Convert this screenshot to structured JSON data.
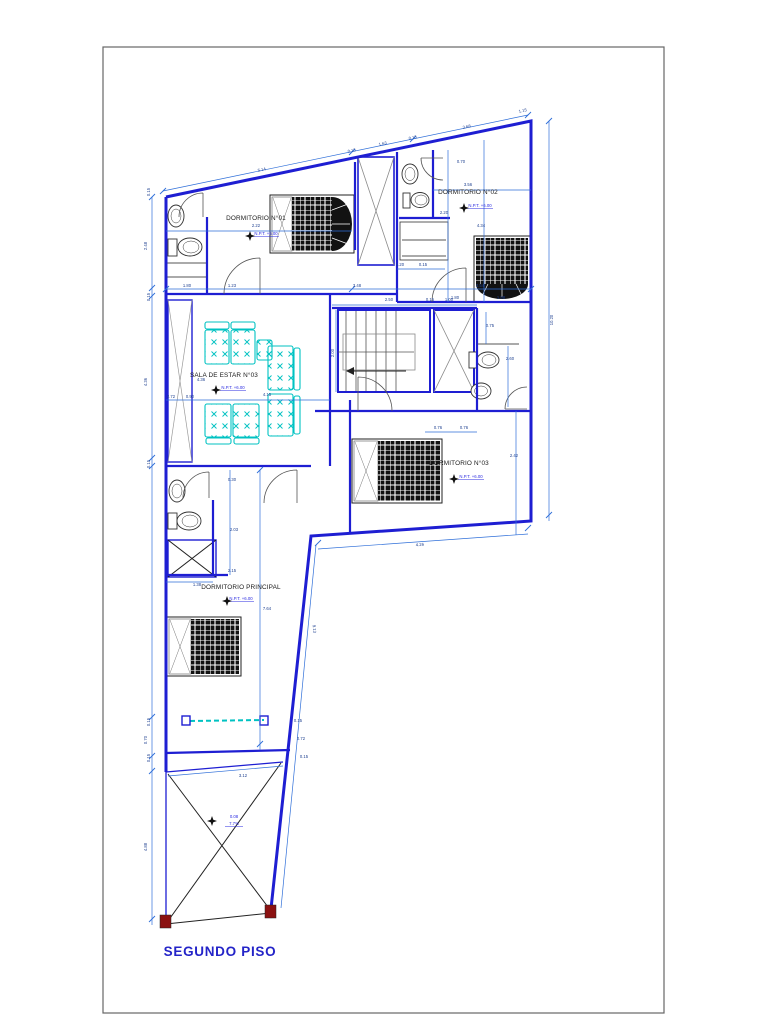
{
  "title": {
    "text": "SEGUNDO PISO"
  },
  "rooms": [
    {
      "label": "DORMITORIO N°01",
      "level": "N.P.T. +6.00",
      "lx": 256,
      "ly": 220,
      "vx": 266,
      "vy": 235,
      "sx": 250,
      "sy": 236
    },
    {
      "label": "DORMITORIO N°02",
      "level": "N.P.T. +6.00",
      "lx": 468,
      "ly": 194,
      "vx": 480,
      "vy": 207,
      "sx": 464,
      "sy": 208
    },
    {
      "label": "SALA DE ESTAR N°03",
      "level": "N.P.T. +6.00",
      "lx": 224,
      "ly": 377,
      "vx": 233,
      "vy": 389,
      "sx": 216,
      "sy": 390
    },
    {
      "label": "DORMITORIO N°03",
      "level": "N.P.T. +6.00",
      "lx": 459,
      "ly": 465,
      "vx": 471,
      "vy": 478,
      "sx": 454,
      "sy": 479
    },
    {
      "label": "DORMITORIO PRINCIPAL",
      "level": "N.P.T. +6.00",
      "lx": 241,
      "ly": 589,
      "vx": 241,
      "vy": 600,
      "sx": 227,
      "sy": 601
    }
  ],
  "patio_note": {
    "line1": "0.08",
    "line2": "7.7%",
    "x": 234,
    "y1": 818,
    "y2": 825,
    "sx": 212,
    "sy": 821
  },
  "dimensions": [
    {
      "t": "5.14",
      "x": 262,
      "y": 171,
      "r": -12
    },
    {
      "t": "0.15",
      "x": 352,
      "y": 152,
      "r": -12
    },
    {
      "t": "1.63",
      "x": 383,
      "y": 145,
      "r": -12
    },
    {
      "t": "0.15",
      "x": 413,
      "y": 139,
      "r": -12
    },
    {
      "t": "3.68",
      "x": 467,
      "y": 128,
      "r": -12
    },
    {
      "t": "1.15",
      "x": 523,
      "y": 112,
      "r": -12
    },
    {
      "t": "0.15",
      "x": 150,
      "y": 192,
      "r": -90
    },
    {
      "t": "2.48",
      "x": 147,
      "y": 246,
      "r": -90
    },
    {
      "t": "0.15",
      "x": 150,
      "y": 297,
      "r": -90
    },
    {
      "t": "4.36",
      "x": 147,
      "y": 382,
      "r": -90
    },
    {
      "t": "0.15",
      "x": 150,
      "y": 464,
      "r": -90
    },
    {
      "t": "0.15",
      "x": 150,
      "y": 722,
      "r": -90
    },
    {
      "t": "0.70",
      "x": 147,
      "y": 740,
      "r": -90
    },
    {
      "t": "0.15",
      "x": 150,
      "y": 758,
      "r": -90
    },
    {
      "t": "4.88",
      "x": 147,
      "y": 847,
      "r": -90
    },
    {
      "t": "10.20",
      "x": 553,
      "y": 320,
      "r": -90
    },
    {
      "t": "2.22",
      "x": 256,
      "y": 227
    },
    {
      "t": "1.80",
      "x": 187,
      "y": 287
    },
    {
      "t": "1.23",
      "x": 232,
      "y": 287
    },
    {
      "t": "3.48",
      "x": 357,
      "y": 287
    },
    {
      "t": "3.54",
      "x": 480,
      "y": 287
    },
    {
      "t": "1.20",
      "x": 400,
      "y": 266
    },
    {
      "t": "0.15",
      "x": 423,
      "y": 266
    },
    {
      "t": "2.50",
      "x": 389,
      "y": 301
    },
    {
      "t": "0.15",
      "x": 430,
      "y": 301
    },
    {
      "t": "1.00",
      "x": 449,
      "y": 301
    },
    {
      "t": "0.70",
      "x": 461,
      "y": 163
    },
    {
      "t": "3.56",
      "x": 468,
      "y": 186
    },
    {
      "t": "2.20",
      "x": 444,
      "y": 214
    },
    {
      "t": "4.34",
      "x": 481,
      "y": 227
    },
    {
      "t": "1.80",
      "x": 455,
      "y": 299
    },
    {
      "t": "1.98",
      "x": 501,
      "y": 299
    },
    {
      "t": "0.75",
      "x": 490,
      "y": 327
    },
    {
      "t": "2.60",
      "x": 510,
      "y": 360
    },
    {
      "t": "0.76",
      "x": 438,
      "y": 429
    },
    {
      "t": "0.76",
      "x": 464,
      "y": 429
    },
    {
      "t": "2.42",
      "x": 514,
      "y": 457
    },
    {
      "t": "4.26",
      "x": 420,
      "y": 546,
      "r": -4
    },
    {
      "t": "4.36",
      "x": 201,
      "y": 381
    },
    {
      "t": "4.15",
      "x": 267,
      "y": 396
    },
    {
      "t": "2.00",
      "x": 334,
      "y": 353,
      "r": -90
    },
    {
      "t": "2.72",
      "x": 171,
      "y": 398
    },
    {
      "t": "0.90",
      "x": 190,
      "y": 398
    },
    {
      "t": "0.30",
      "x": 232,
      "y": 481
    },
    {
      "t": "2.03",
      "x": 234,
      "y": 531
    },
    {
      "t": "2.15",
      "x": 232,
      "y": 572
    },
    {
      "t": "1.38",
      "x": 197,
      "y": 586
    },
    {
      "t": "7.64",
      "x": 267,
      "y": 610
    },
    {
      "t": "9.13",
      "x": 313,
      "y": 629,
      "r": 84
    },
    {
      "t": "3.12",
      "x": 243,
      "y": 777
    },
    {
      "t": "0.15",
      "x": 298,
      "y": 722
    },
    {
      "t": "0.72",
      "x": 301,
      "y": 740
    },
    {
      "t": "0.15",
      "x": 304,
      "y": 758
    }
  ],
  "colors": {
    "wall_blue": "#1e1ed2",
    "dimension_blue": "#2f6fd9",
    "furniture_cyan": "#00c2c2",
    "label_blue": "#2a2ae0",
    "title_blue": "#2424c8",
    "column_red": "#8b1111"
  }
}
